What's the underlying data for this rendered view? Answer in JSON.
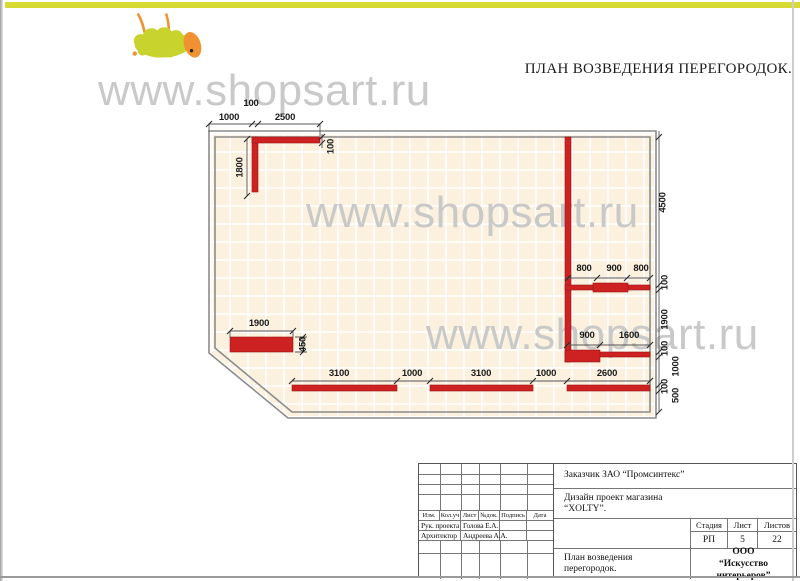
{
  "page": {
    "title": "ПЛАН ВОЗВЕДЕНИЯ ПЕРЕГОРОДОК.",
    "watermark_text": "www.shopsart.ru",
    "colors": {
      "top_bar_yellow": "#d7db34",
      "partition_red": "#ce2121",
      "plan_background": "#fbf1de",
      "wall_outline_gray": "#8c8c8c",
      "watermark_gray": "#c7c7c7",
      "logo_body_green": "#c9d32e",
      "logo_head_orange": "#f09132"
    }
  },
  "plan": {
    "dims": {
      "top_100": "100",
      "top_1000": "1000",
      "top_2500": "2500",
      "left_1800": "1800",
      "wall_100": "100",
      "right_4500": "4500",
      "right_100a": "100",
      "right_1900": "1900",
      "right_100b": "100",
      "right_1000": "1000",
      "right_100c": "100",
      "right_500": "500",
      "mid_800a": "800",
      "mid_900": "900",
      "mid_800b": "800",
      "low_900": "900",
      "low_1600": "1600",
      "rect_1900": "1900",
      "rect_450": "450",
      "bot_3100a": "3100",
      "bot_1000a": "1000",
      "bot_3100b": "3100",
      "bot_1000b": "1000",
      "bot_2600": "2600"
    }
  },
  "title_block": {
    "customer": "Заказчик ЗАО  “Промсинтекс”",
    "project_line1": "Дизайн проект магазина",
    "project_line2": "“XOLTY”.",
    "columns": {
      "izm": "Изм.",
      "koluch": "Кол.уч",
      "list": "Лист",
      "ndok": "№док.",
      "podpis": "Подпись",
      "data": "Дата"
    },
    "roles": {
      "manager_label": "Рук. проекта",
      "manager_name": "Голова Е.А.",
      "architect_label": "Архитектор",
      "architect_name": "Андреева А.А."
    },
    "stage": {
      "header": "Стадия",
      "value": "РП"
    },
    "sheet": {
      "header": "Лист",
      "value": "5"
    },
    "sheets": {
      "header": "Листов",
      "value": "22"
    },
    "drawing_line1": "План возведения",
    "drawing_line2": "перегородок.",
    "company_line1": "ООО",
    "company_line2": "“Искусство интерьеров”"
  }
}
